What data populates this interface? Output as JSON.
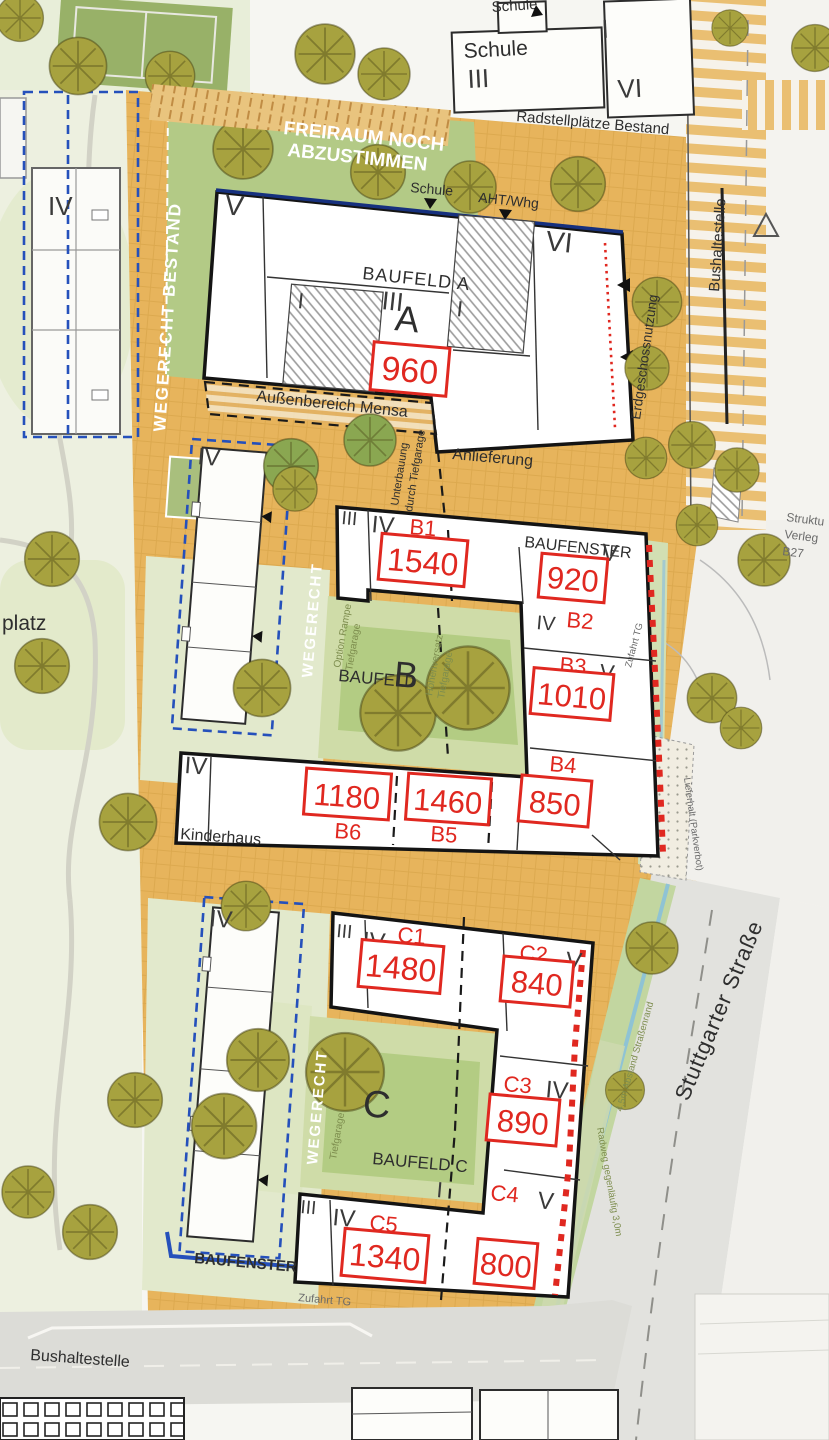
{
  "colors": {
    "accent_red": "#e02820",
    "baufenster_blue": "#2550bb",
    "navy_boundary": "#16307e",
    "paving_orange": "#e7b45c",
    "courtyard_green": "#cfdca8",
    "tree_olive": "#a7a23f",
    "road_gray": "#e2e2de"
  },
  "labels": {
    "freiraum_line1": "FREIRAUM NOCH",
    "freiraum_line2": "ABZUSTIMMEN",
    "wegerecht_bestand": "WEGERECHT BESTAND",
    "wegerecht_b": "WEGERECHT",
    "wegerecht_c": "WEGERECHT",
    "platz": "platz",
    "schule_small": "Schule",
    "schule_main": "Schule",
    "schule_at_entrance": "Schule",
    "aht_whg": "AHT/Whg",
    "radstellplaetze": "Radstellplätze Bestand",
    "bushaltestelle_right": "Bushaltestelle",
    "bushaltestelle_bottom": "Bushaltestelle",
    "erdgeschossnutzung": "Erdgeschossnutzung",
    "aussenbereich_mensa": "Außenbereich Mensa",
    "anlieferung": "Anlieferung",
    "unterbauung_line1": "Unterbauung",
    "unterbauung_line2": "durch Tiefgarage",
    "kinderhaus": "Kinderhaus",
    "baufenster_b": "BAUFENSTER",
    "baufenster_c": "BAUFENSTER",
    "option_rampe_line1": "Option Rampe",
    "option_rampe_line2": "Tiefgarage",
    "hoehenversatz_line1": "Höhenversatz",
    "hoehenversatz_line2": "Tiefgarage",
    "tiefgarage_c": "Tiefgarage",
    "zufahrt_tg_b": "Zufahrt TG",
    "zufahrt_tg_c": "Zufahrt TG",
    "lieferhalt": "Lieferhalt (Parkverbot)",
    "stuttgarter_strasse": "Stuttgarter Straße",
    "struktur_line1": "Struktu",
    "struktur_line2": "Verleg",
    "struktur_line3": "B27",
    "abstand_strassenrand": "4,5m Abstand Straßenrand",
    "radweg_gegenlaeufig": "Radweg gegenläufig 3,0m"
  },
  "baufelder": {
    "a_name": "BAUFELD A",
    "a_big": "A",
    "b_name": "BAUFELD",
    "b_big": "B",
    "c_name": "BAUFELD C",
    "c_big": "C"
  },
  "units": {
    "a": {
      "label": "A",
      "area": "960"
    },
    "b1": {
      "label": "B1",
      "area": "1540"
    },
    "b2": {
      "label": "B2",
      "area": "920"
    },
    "b3": {
      "label": "B3",
      "area": "1010"
    },
    "b4": {
      "label": "B4",
      "area": "850"
    },
    "b5": {
      "label": "B5",
      "area": "1460"
    },
    "b6": {
      "label": "B6",
      "area": "1180"
    },
    "c1": {
      "label": "C1",
      "area": "1480"
    },
    "c2": {
      "label": "C2",
      "area": "840"
    },
    "c3": {
      "label": "C3",
      "area": "890"
    },
    "c4": {
      "label": "C4",
      "area": "800"
    },
    "c5": {
      "label": "C5",
      "area": "1340"
    }
  },
  "floors": {
    "school_iii": "III",
    "school_i": "I",
    "school_vi": "VI",
    "a_v": "V",
    "a_vi": "VI",
    "a_iii": "III",
    "a_i_left": "I",
    "a_i_right": "I",
    "left_top": "IV",
    "left_mid": "IV",
    "left_bottom": "IV",
    "b_iii": "III",
    "b1_iv": "IV",
    "b2_v": "V",
    "b2_iv": "IV",
    "b3_v": "V",
    "kinderhaus_iv": "IV",
    "c_iii": "III",
    "c1_iv": "IV",
    "c2_v": "V",
    "c3_iv": "IV",
    "c4_v": "V",
    "c5_iii": "III",
    "c5_iv": "IV",
    "c_low_i": "I"
  }
}
